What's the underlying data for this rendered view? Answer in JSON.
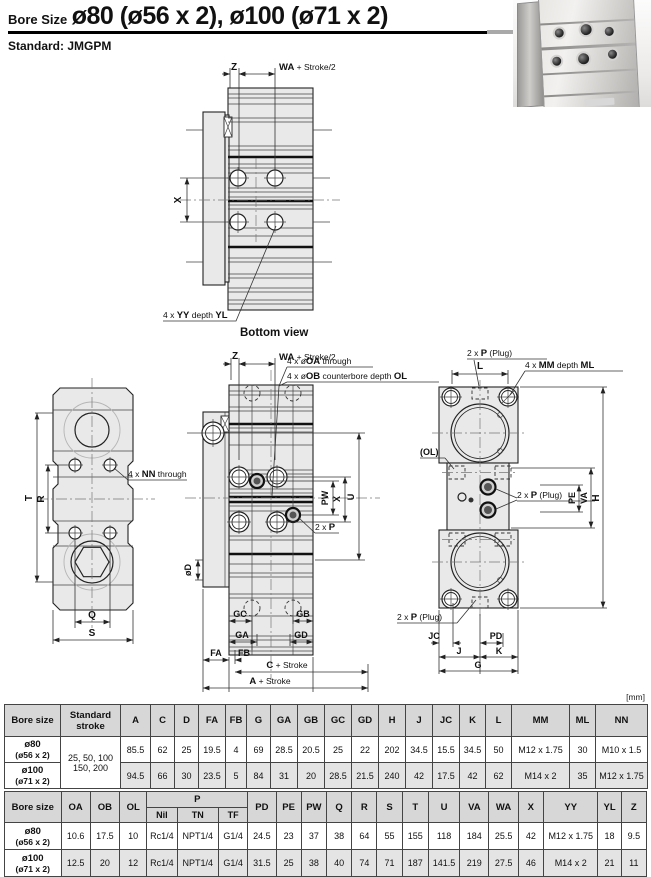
{
  "page": {
    "title_prefix": "Bore Size",
    "title_main": "ø80 (ø56 x 2), ø100 (ø71 x 2)",
    "subtitle_label": "Standard:",
    "subtitle_value": "JMGPM",
    "units_note": "[mm]"
  },
  "labels": {
    "z": "Z",
    "x": "X",
    "t": "T",
    "r": "R",
    "q": "Q",
    "s": "S",
    "d": "øD",
    "pw": "PW",
    "u": "U",
    "gc": "GC",
    "ga": "GA",
    "gb": "GB",
    "gd": "GD",
    "fa": "FA",
    "fb": "FB",
    "l": "L",
    "ol_paren": "(OL)",
    "pe": "PE",
    "va": "VA",
    "h": "H",
    "jc": "JC",
    "j": "J",
    "pd": "PD",
    "k": "K",
    "g": "G",
    "wa": {
      "p1": "WA",
      "p2": " + Stroke/2"
    },
    "c_stroke": {
      "p1": "C",
      "p2": " + Stroke"
    },
    "a_stroke": {
      "p1": "A",
      "p2": " + Stroke"
    },
    "yy": {
      "p1": "4 x ",
      "p2": "YY",
      "p3": " depth ",
      "p4": "YL"
    },
    "nn": {
      "p1": "4 x ",
      "p2": "NN",
      "p3": " through"
    },
    "oa": {
      "p1": "4 x ø",
      "p2": "OA",
      "p3": " through"
    },
    "ob": {
      "p1": "4 x ø",
      "p2": "OB",
      "p3": " counterbore depth ",
      "p4": "OL"
    },
    "mm": {
      "p1": "4 x ",
      "p2": "MM",
      "p3": " depth ",
      "p4": "ML"
    },
    "p_plug": {
      "p1": "2 x ",
      "p2": "P",
      "p3": " (Plug)"
    },
    "p2": {
      "p1": "2 x ",
      "p2": "P"
    },
    "bottom_caption": "Bottom view"
  },
  "table1": {
    "col_headers": [
      "Bore size",
      "Standard stroke",
      "A",
      "C",
      "D",
      "FA",
      "FB",
      "G",
      "GA",
      "GB",
      "GC",
      "GD",
      "H",
      "J",
      "JC",
      "K",
      "L",
      "MM",
      "ML",
      "NN"
    ],
    "stroke_lines": [
      "25, 50, 100",
      "150, 200"
    ],
    "rows": [
      {
        "bore_line1": "ø80",
        "bore_line2": "(ø56 x 2)",
        "values": [
          "85.5",
          "62",
          "25",
          "19.5",
          "4",
          "69",
          "28.5",
          "20.5",
          "25",
          "22",
          "202",
          "34.5",
          "15.5",
          "34.5",
          "50",
          "M12 x 1.75",
          "30",
          "M10 x 1.5"
        ]
      },
      {
        "bore_line1": "ø100",
        "bore_line2": "(ø71 x 2)",
        "values": [
          "94.5",
          "66",
          "30",
          "23.5",
          "5",
          "84",
          "31",
          "20",
          "28.5",
          "21.5",
          "240",
          "42",
          "17.5",
          "42",
          "62",
          "M14 x 2",
          "35",
          "M12 x 1.75"
        ]
      }
    ]
  },
  "table2": {
    "col_headers_top": [
      "Bore size",
      "OA",
      "OB",
      "OL",
      "P",
      "PD",
      "PE",
      "PW",
      "Q",
      "R",
      "S",
      "T",
      "U",
      "VA",
      "WA",
      "X",
      "YY",
      "YL",
      "Z"
    ],
    "p_subheaders": [
      "Nil",
      "TN",
      "TF"
    ],
    "rows": [
      {
        "bore_line1": "ø80",
        "bore_line2": "(ø56 x 2)",
        "values": [
          "10.6",
          "17.5",
          "10",
          "Rc1/4",
          "NPT1/4",
          "G1/4",
          "24.5",
          "23",
          "37",
          "38",
          "64",
          "55",
          "155",
          "118",
          "184",
          "25.5",
          "42",
          "M12 x 1.75",
          "18",
          "9.5"
        ]
      },
      {
        "bore_line1": "ø100",
        "bore_line2": "(ø71 x 2)",
        "values": [
          "12.5",
          "20",
          "12",
          "Rc1/4",
          "NPT1/4",
          "G1/4",
          "31.5",
          "25",
          "38",
          "40",
          "74",
          "71",
          "187",
          "141.5",
          "219",
          "27.5",
          "46",
          "M14 x 2",
          "21",
          "11"
        ]
      }
    ]
  }
}
